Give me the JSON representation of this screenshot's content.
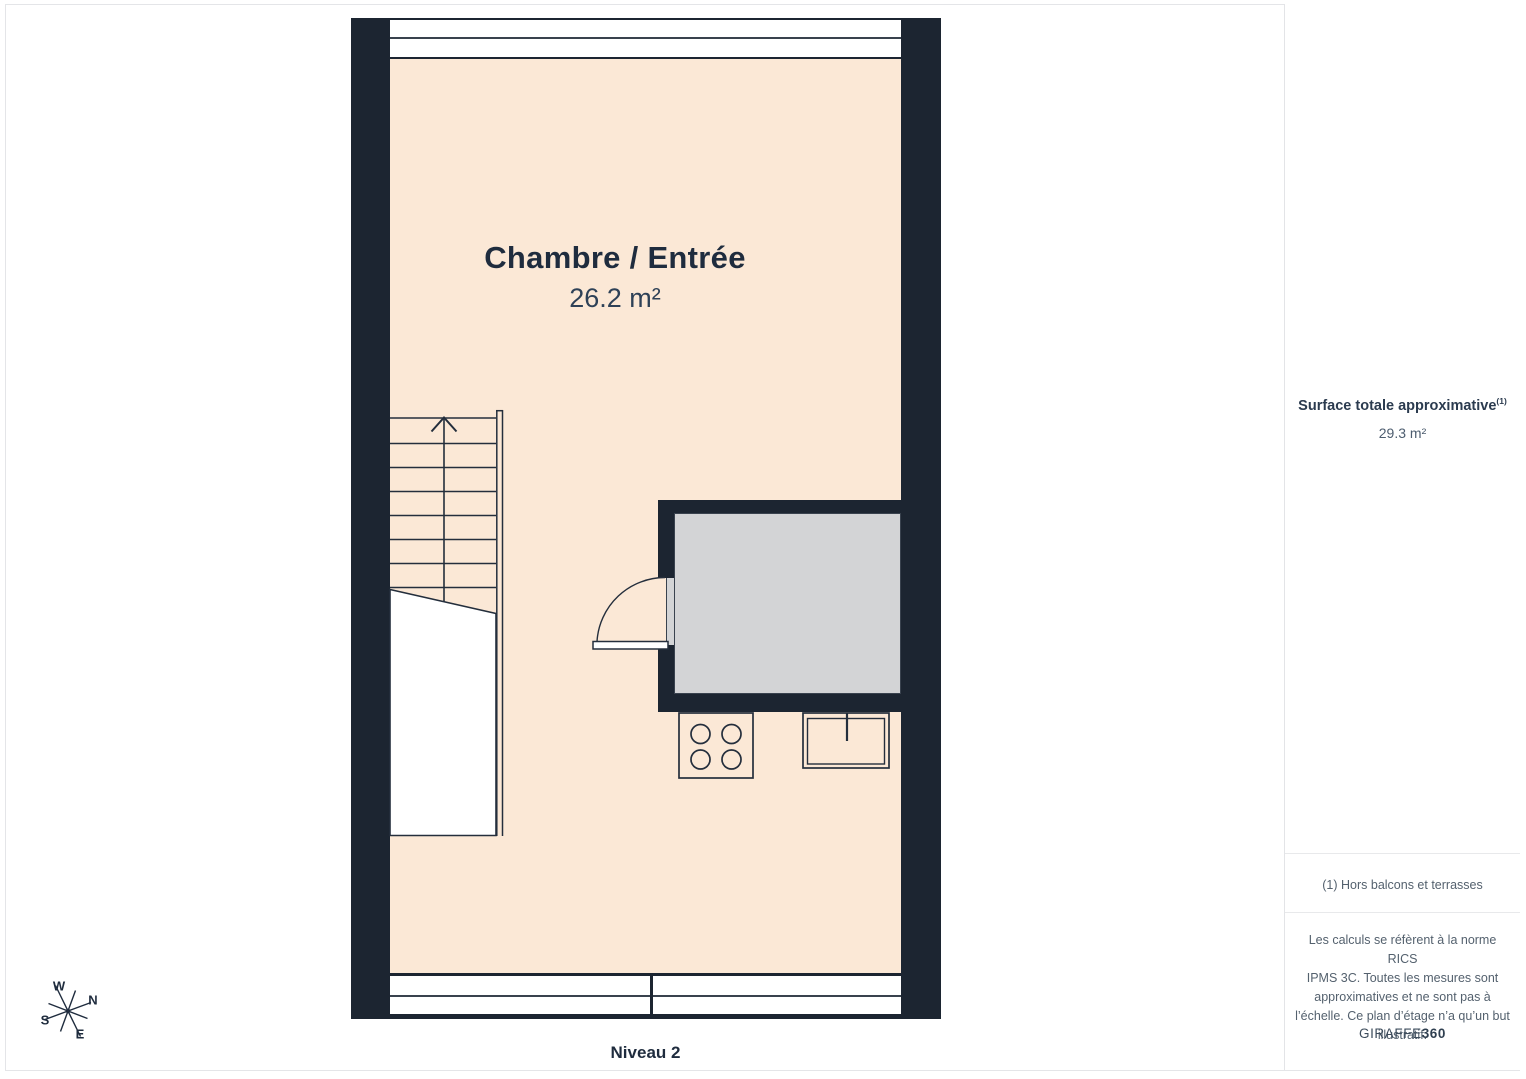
{
  "page": {
    "level_label": "Niveau 2"
  },
  "floor_plan": {
    "room_label": "Chambre / Entrée",
    "room_area": "26.2 m²",
    "compass": {
      "n": "N",
      "e": "E",
      "s": "S",
      "w": "W"
    }
  },
  "sidebar": {
    "surface_title": "Surface totale approximative",
    "surface_marker": "(1)",
    "surface_value": "29.3 m²",
    "footnote": "(1) Hors balcons et terrasses",
    "disclaimer": "Les calculs se réfèrent à la norme RICS\nIPMS 3C. Toutes les mesures sont\napproximatives et ne sont pas à\nl’échelle. Ce plan d’étage n’a qu’un but\nillustratif.",
    "brand_name": "GIRAFFE",
    "brand_suffix": "360"
  },
  "colors": {
    "wall": "#1C2531",
    "floor": "#FBE8D6",
    "wet_room_floor": "#D3D4D6",
    "text_navy": "#1F2C3E",
    "text_gray": "#54616E",
    "frame_border": "#E4E5E8"
  }
}
